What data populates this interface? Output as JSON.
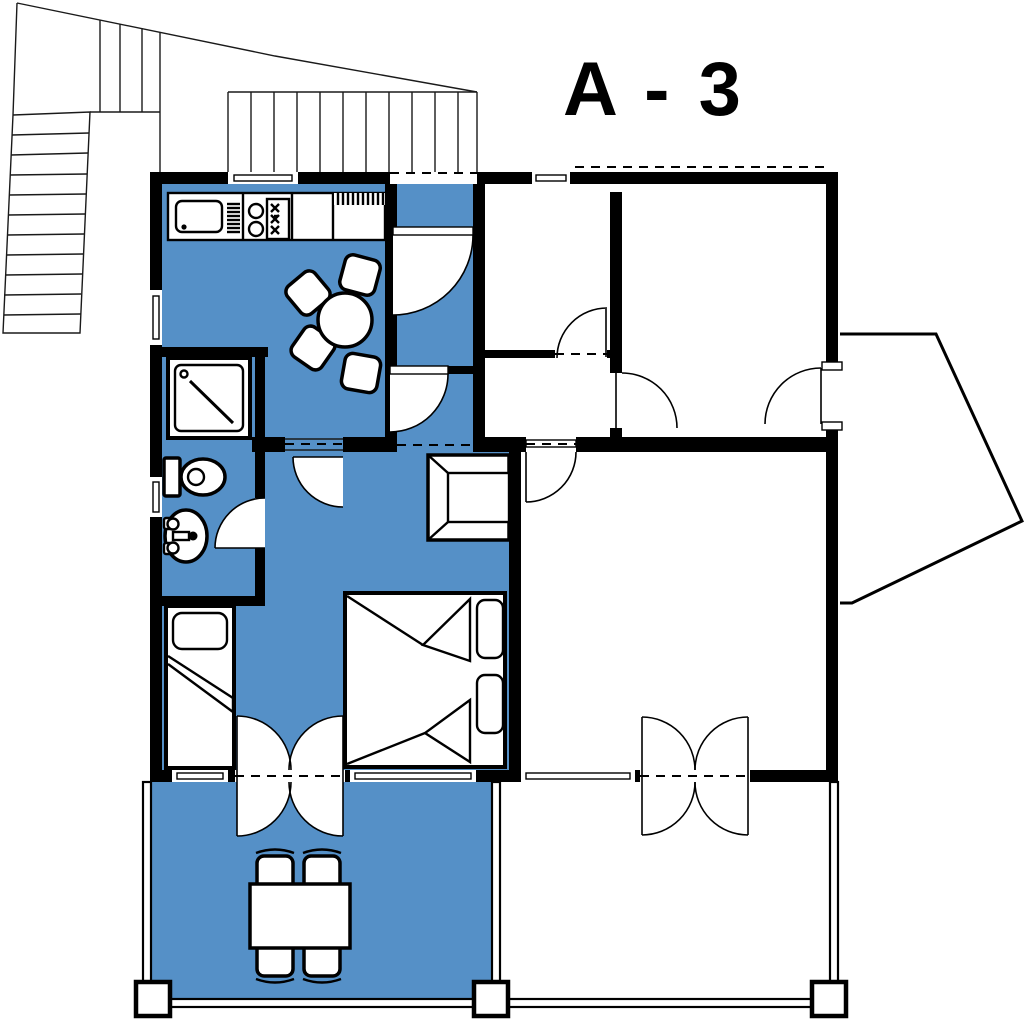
{
  "title": "A - 3",
  "colors": {
    "apartment": "#5590C7",
    "wall": "#000000",
    "line": "#1A1A1A",
    "background": "#FFFFFF"
  },
  "plan": {
    "unit_label": "A - 3",
    "highlighted_unit_color": "#5590C7",
    "highlighted_areas": [
      "kitchen-dining",
      "entry-corridor",
      "bathroom",
      "bedroom-living",
      "terrace"
    ],
    "fixtures": [
      "kitchen-sink",
      "cooktop",
      "kitchen-counter",
      "dining-table",
      "dining-chair",
      "shower",
      "toilet",
      "washbasin",
      "single-bed",
      "double-bed",
      "pillow",
      "wardrobe",
      "terrace-table",
      "terrace-chair"
    ],
    "features": [
      "exterior-stairs",
      "entrance-stairs",
      "entrance-door",
      "interior-door-swings",
      "french-doors",
      "windows",
      "balcony",
      "neighbor-rooms",
      "neighbor-terrace"
    ]
  }
}
